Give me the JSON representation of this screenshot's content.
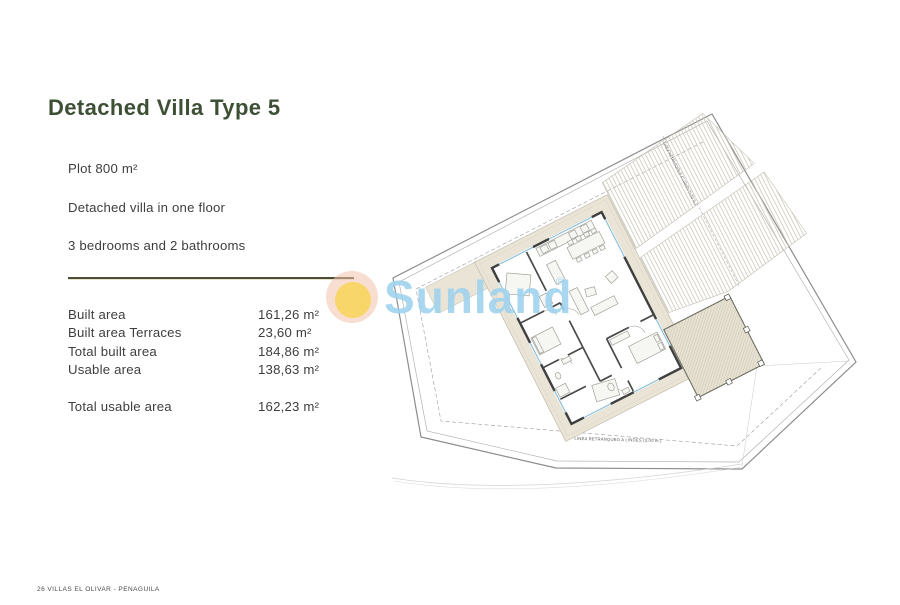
{
  "header": {
    "title": "Detached Villa Type 5",
    "title_color": "#3d5035"
  },
  "specs": {
    "lines": [
      "Plot 800 m²",
      "Detached villa in one floor",
      "3 bedrooms and 2 bathrooms"
    ]
  },
  "areas": {
    "rows": [
      {
        "label": "Built area",
        "value": "161,26 m²"
      },
      {
        "label": "Built area Terraces",
        "value": "23,60 m²"
      },
      {
        "label": "Total built area",
        "value": "184,86 m²"
      },
      {
        "label": "Usable area",
        "value": "138,63 m²"
      }
    ],
    "total": {
      "label": "Total usable area",
      "value": "162,23 m²"
    }
  },
  "watermark": {
    "brand": "Sunland",
    "reg": "®",
    "text_color": "#9fd2ef",
    "outer_circle_color": "#f3c2ab",
    "inner_circle_color": "#f8d34f"
  },
  "plan": {
    "setback_label_right": "LINEA RETRANQUEO A LINDES (3,00 m.)",
    "setback_label_bottom": "LINEA RETRANQUEO A LINDES (3,00 m.)"
  },
  "footer": {
    "text": "26  VILLAS EL OLIVAR - PENAGUILA"
  }
}
